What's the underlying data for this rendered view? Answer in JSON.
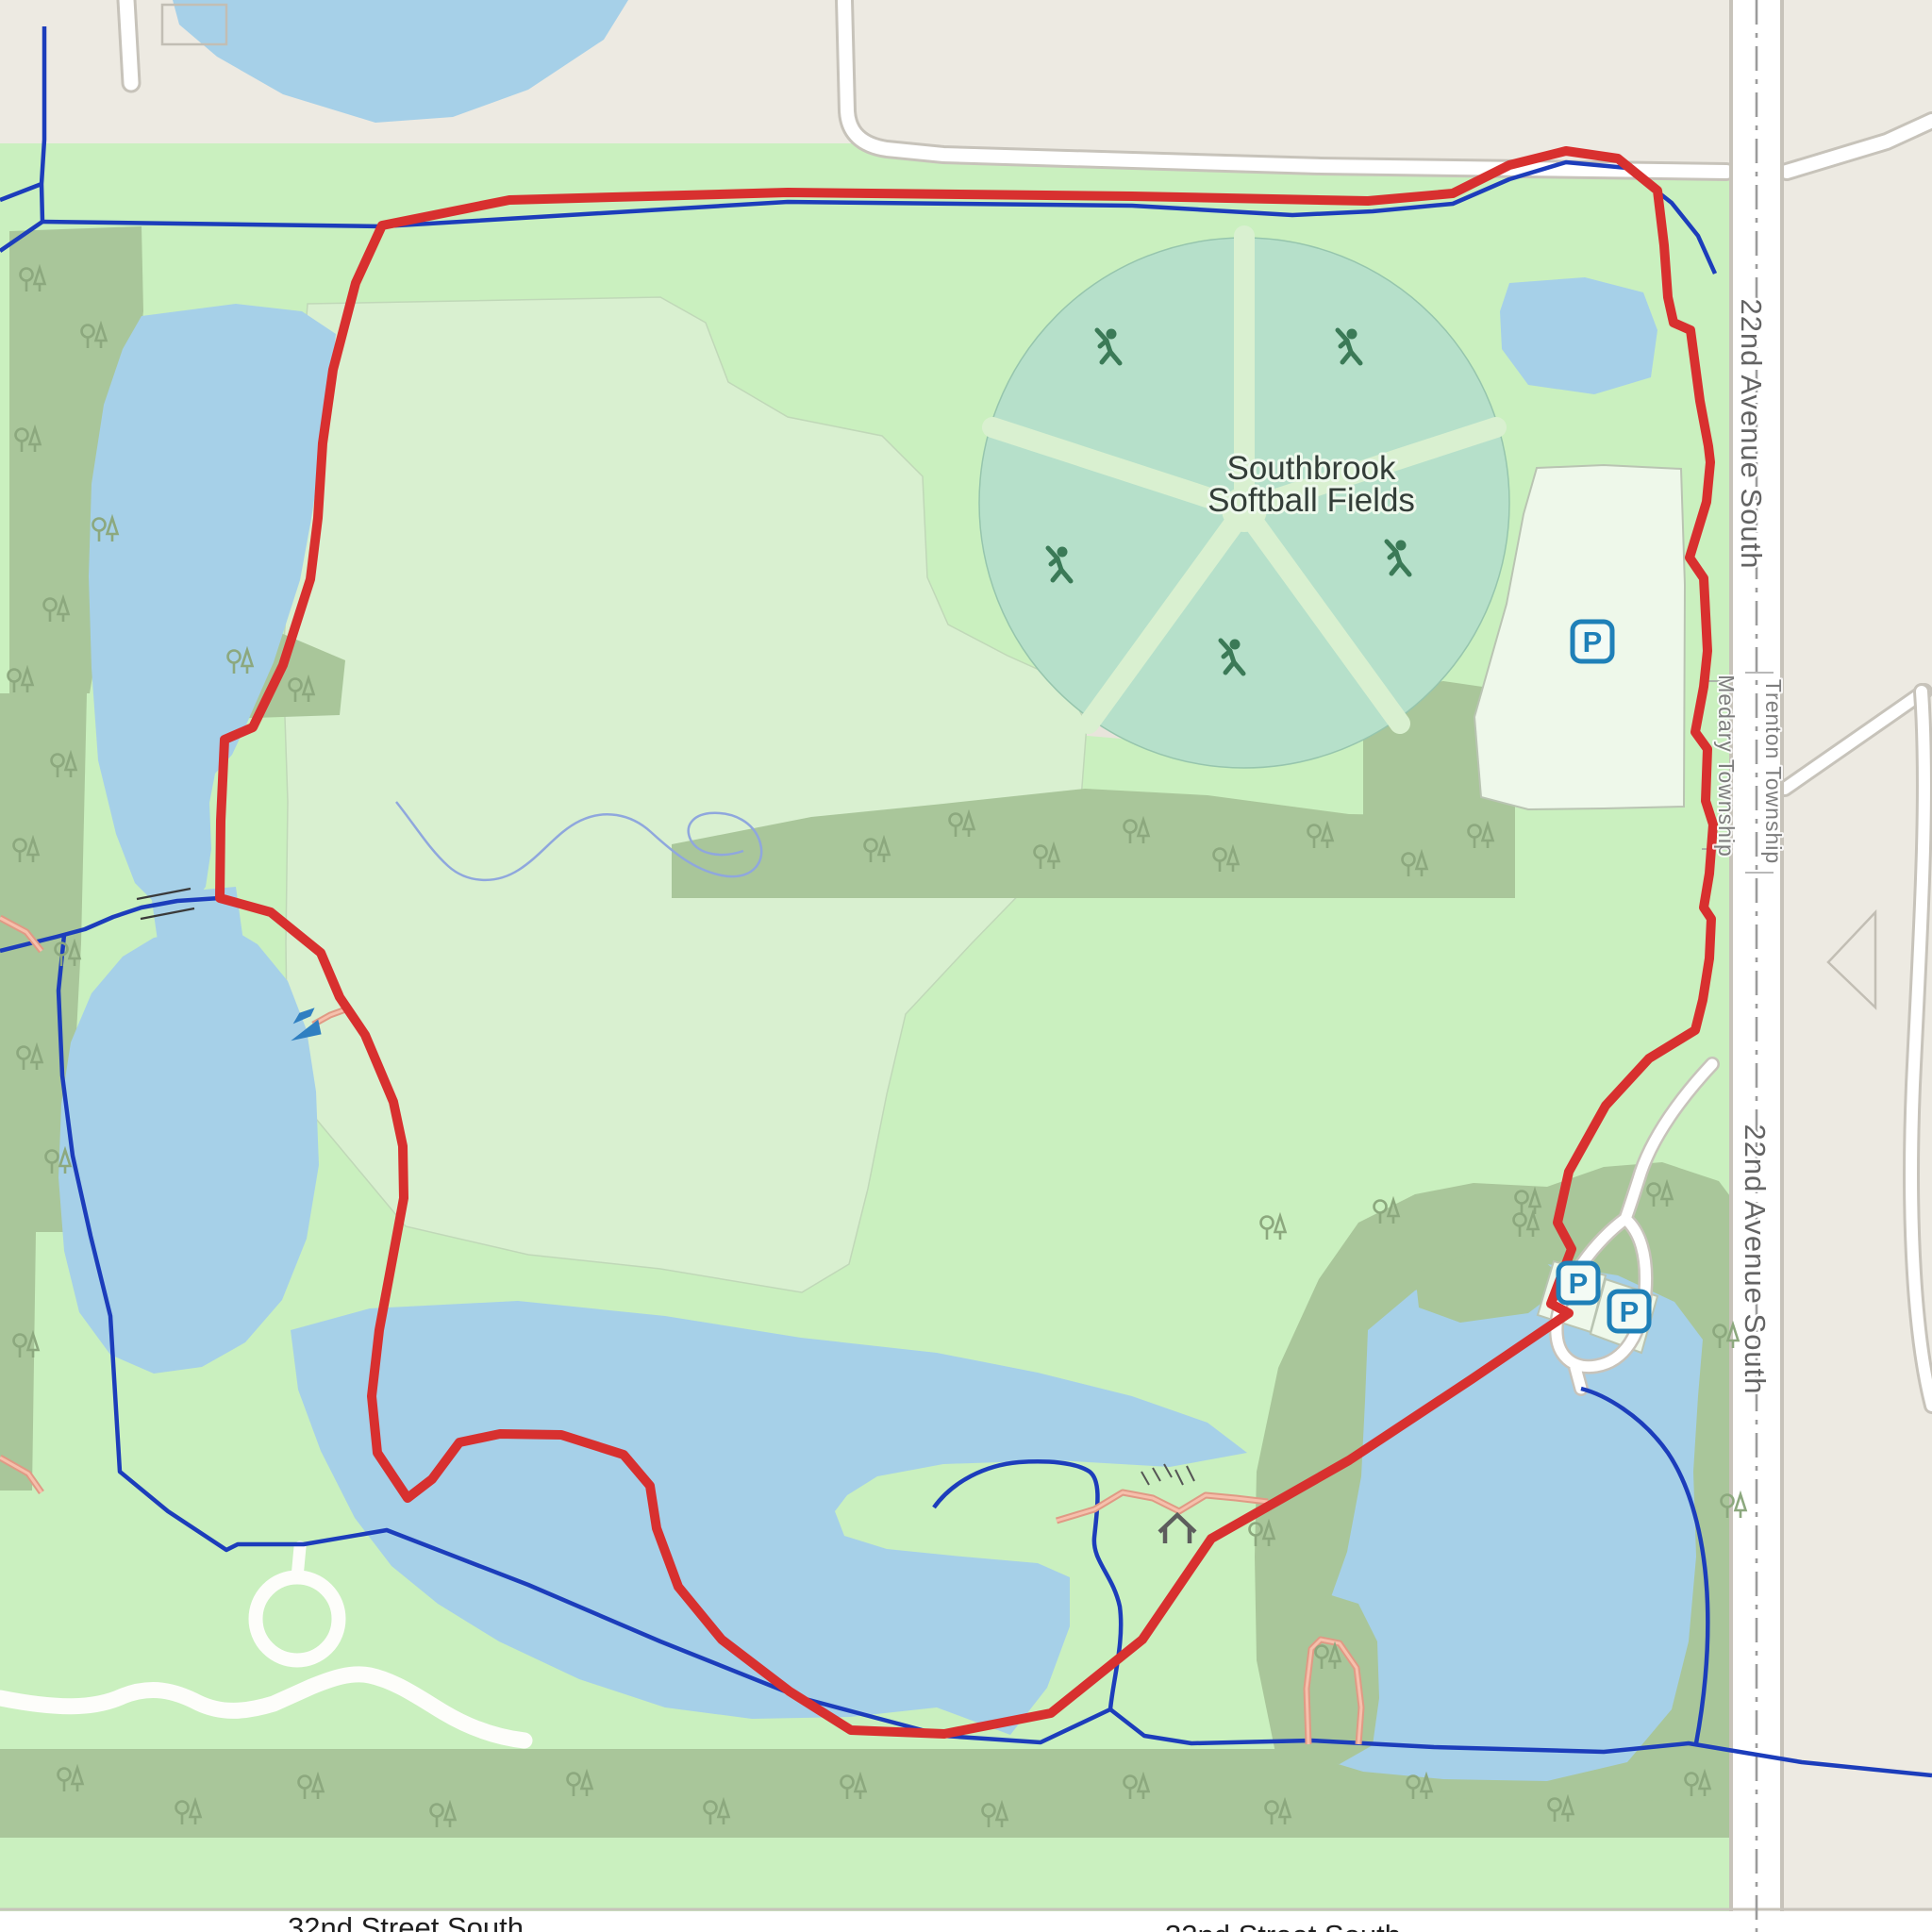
{
  "map_labels": {
    "place": {
      "line1": "Southbrook",
      "line2": "Softball Fields"
    },
    "roads": {
      "avenue_upper": "22nd Avenue South",
      "avenue_lower": "22nd Avenue South",
      "street_sw": "32nd Street South",
      "street_se": "32nd Street South"
    },
    "boundary": {
      "west": "Medary Township",
      "east": "Trenton Township"
    },
    "markers": {
      "parking_letter": "P"
    }
  },
  "icons": [
    "parking-icon",
    "softball-batter-icon",
    "slipway-icon",
    "picnic-shelter-icon",
    "steps-icon",
    "tree-pair-icon",
    "bridge-icon"
  ],
  "colors": {
    "route_red": "#d8302f",
    "trail_blue": "#1c3dbb",
    "water_blue": "#a6d0e8",
    "park_green": "#caf0bf",
    "wood_green": "#a9c69a",
    "pitch_teal": "#b6e0ca",
    "path_pink": "#e09a85",
    "parking_blue": "#1f80b8",
    "land_beige": "#edeae2"
  }
}
